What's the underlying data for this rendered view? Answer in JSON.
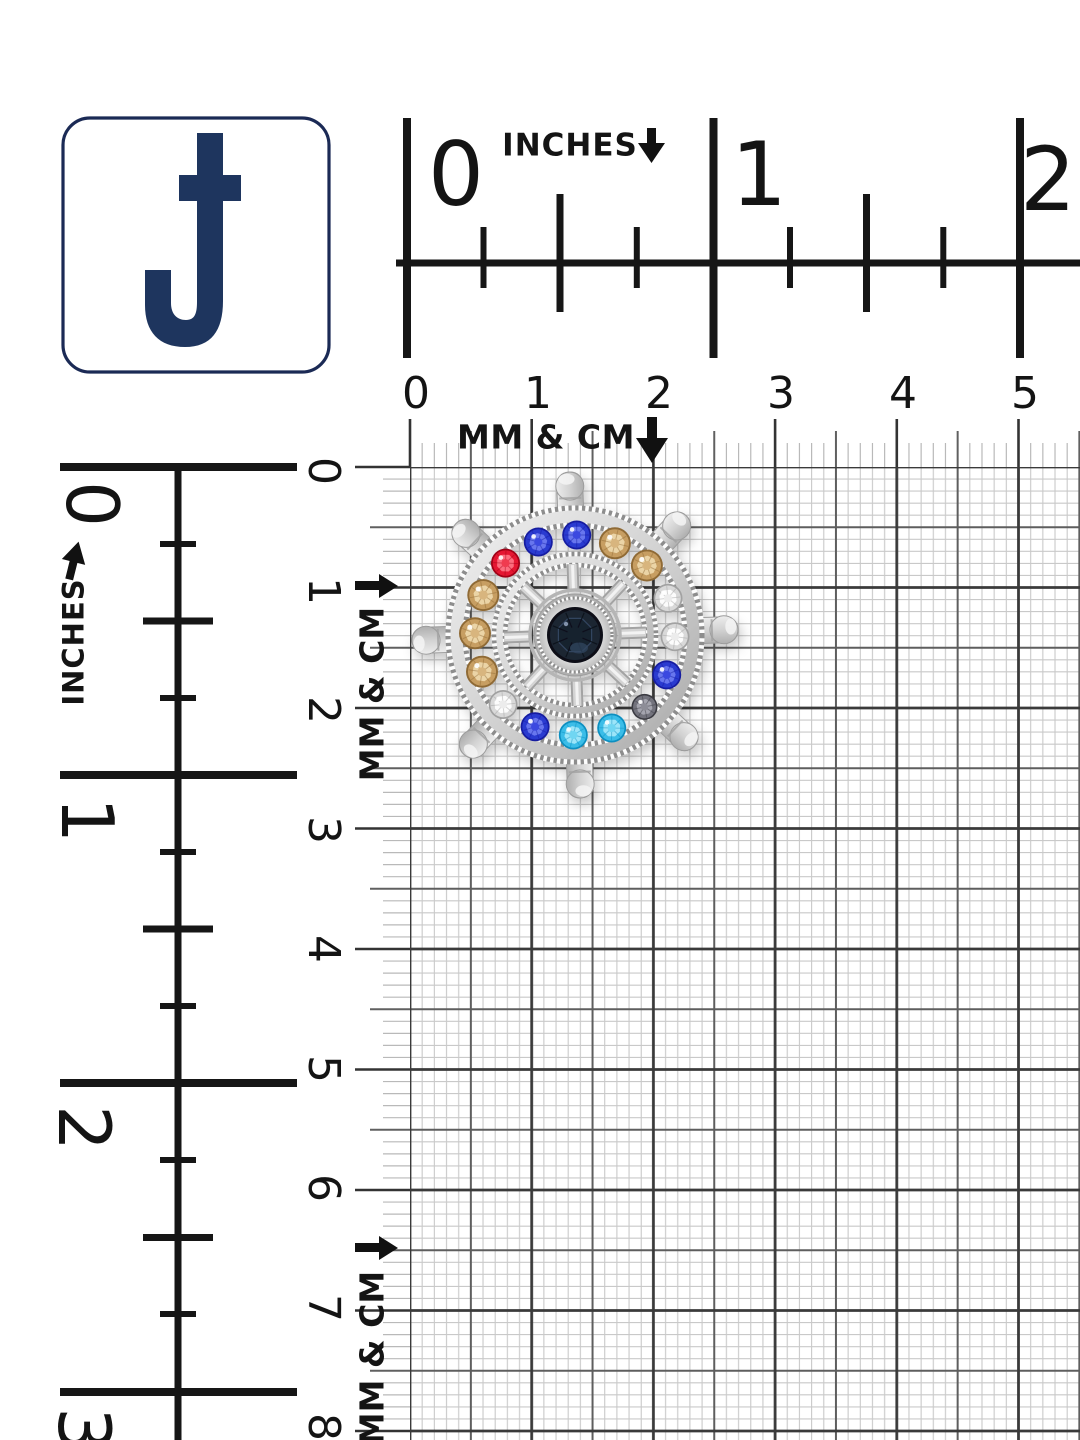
{
  "logo": {
    "letter": "J",
    "border_color": "#1b2a55",
    "letter_color": "#1e355e"
  },
  "rulers": {
    "top_inches": {
      "unit_label": "INCHES",
      "arrow": "down",
      "labels": [
        "0",
        "1",
        "2"
      ]
    },
    "top_cm": {
      "unit_label": "MM & CM",
      "arrow": "down",
      "labels": [
        "0",
        "1",
        "2",
        "3",
        "4",
        "5"
      ]
    },
    "left_inches": {
      "unit_label": "INCHES",
      "arrow": "up",
      "labels": [
        "0",
        "1",
        "2",
        "3"
      ]
    },
    "left_cm": {
      "unit_label_top": "MM & CM",
      "unit_label_bottom": "MM & CM",
      "arrow": "right",
      "labels": [
        "0",
        "1",
        "2",
        "3",
        "4",
        "5",
        "6",
        "7",
        "8"
      ]
    }
  },
  "product": {
    "name": "Silver nautical ship-wheel brooch with multicolor rhinestones on measurement grid",
    "handle_count": 8,
    "stone_count": 16,
    "center_stone_color_name": "navy",
    "metal_color": "#cfcfcf",
    "stones_clockwise_from_top": [
      "blue",
      "champagne",
      "champagne",
      "clear",
      "clear",
      "blue",
      "smoke",
      "aqua",
      "aqua",
      "blue",
      "clear",
      "champagne",
      "champagne",
      "champagne",
      "red",
      "blue"
    ],
    "palettes": {
      "blue": {
        "base": "#2b3ad0",
        "light": "#6e7cf0",
        "dark": "#141da0",
        "mid": "#3a4ae0"
      },
      "red": {
        "base": "#e51730",
        "light": "#ff7585",
        "dark": "#a00418",
        "mid": "#f03a50"
      },
      "champagne": {
        "base": "#c79e62",
        "light": "#eed9ab",
        "dark": "#8f6a36",
        "mid": "#d8b57e"
      },
      "clear": {
        "base": "#d9d9d9",
        "light": "#ffffff",
        "dark": "#a2a2a2",
        "mid": "#ececec"
      },
      "aqua": {
        "base": "#3bbde8",
        "light": "#a5e8fa",
        "dark": "#0f8fc0",
        "mid": "#6fd6f2"
      },
      "smoke": {
        "base": "#73737d",
        "light": "#a8a8b2",
        "dark": "#3a3a42",
        "mid": "#8d8d97"
      },
      "center": {
        "base": "#1c2533",
        "light": "#32455f",
        "dark": "#0c1019",
        "mid": "#243044"
      }
    }
  }
}
